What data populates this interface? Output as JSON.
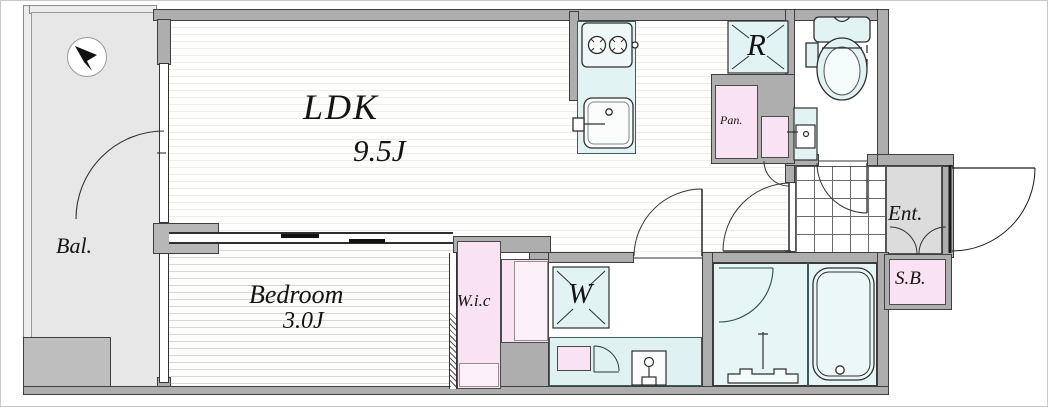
{
  "plan_labels": {
    "ldk": {
      "name": "LDK",
      "size": "9.5J"
    },
    "bedroom": {
      "name": "Bedroom",
      "size": "3.0J"
    },
    "balcony": "Bal.",
    "walk_in_closet": "W.i.c",
    "washer": "W",
    "refrigerator": "R",
    "pantry": "Pan.",
    "entrance": "Ent.",
    "shoe_box": "S.B."
  },
  "colors": {
    "wall_gray": "#aeaeae",
    "balcony_floor": "#e7e7e7",
    "fixture_cyan": "#e2f3f3",
    "closet_pink": "#f9e2f2",
    "closet_pink_light": "#fcf1f8",
    "outline": "#3f3f3f"
  }
}
